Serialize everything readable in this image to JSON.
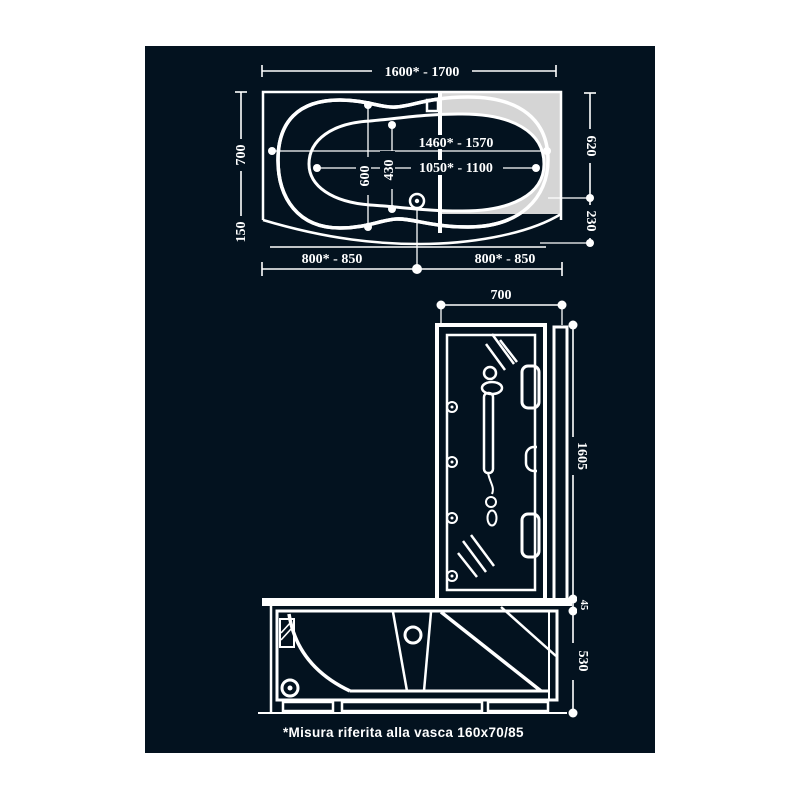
{
  "colors": {
    "background": "#ffffff",
    "panel": "#03121f",
    "line": "#ffffff",
    "glass_panel": "#d5d5d5"
  },
  "plan_view": {
    "overall_length": "1600* - 1700",
    "overall_width": "700",
    "apron_depth": "150",
    "basin_length": "1460* - 1570",
    "tap_distance": "1050* - 1100",
    "basin_width": "600",
    "drain_width": "430",
    "side_upper": "620",
    "side_lower": "230",
    "drain_from_left": "800* - 850",
    "drain_from_right": "800* - 850"
  },
  "front_view": {
    "column_width": "700",
    "column_height": "1605",
    "rim_height": "45",
    "tub_height": "530"
  },
  "footnote": "*Misura riferita alla vasca 160x70/85"
}
